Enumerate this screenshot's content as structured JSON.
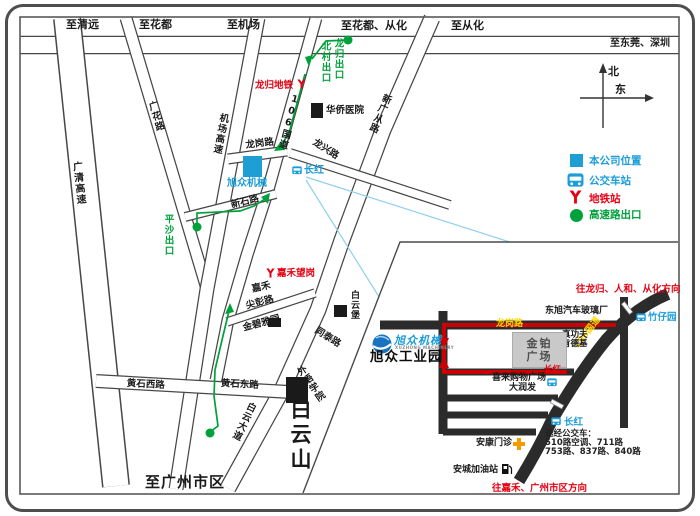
{
  "colors": {
    "company_blue": "#1b9dd9",
    "metro_red": "#e60012",
    "route_green": "#00a13b",
    "road_label_yellow": "#ffd800",
    "route_red": "#cc0000"
  },
  "top": {
    "qingyuan": "至清远",
    "huadu": "至花都",
    "airport": "至机场",
    "huadu_conghua": "至花都、从化",
    "conghua": "至从化",
    "dongguan_shenzhen": "至东莞、深圳"
  },
  "compass": {
    "north": "北",
    "east": "东"
  },
  "legend": {
    "company": "本公司位置",
    "bus_station": "公交车站",
    "metro_station": "地铁站",
    "highway_exit": "高速路出口"
  },
  "roads": {
    "guangqing_expwy": "广清高速",
    "guanghua_rd": "广花路",
    "airport_expwy": "机场高速",
    "national_rd_106": "106国道",
    "xinguangcong_rd": "新广从路",
    "longgang_rd": "龙岗路",
    "longxing_rd": "龙兴路",
    "xinshi_rd": "新石路",
    "jianpeng_rd": "尖彭路",
    "tongtai_rd": "同泰路",
    "huangshi_west_rd": "黄石西路",
    "huangshi_east_rd": "黄石东路",
    "baiyun_ave": "白云大道"
  },
  "places": {
    "longgui_metro": "龙归地铁",
    "beicun_exit": "北村出口",
    "longgui_exit": "龙归出口",
    "pingsha_exit": "平沙出口",
    "overseas_hospital": "华侨医院",
    "changhong": "长红",
    "company_name": "旭众机械",
    "jiahe_wanggang": "嘉禾望岗",
    "jiahe": "嘉禾",
    "jinbi_garden": "金碧雅园",
    "baiyun_fort": "白云堡",
    "foreign_college": "外语学院",
    "baiyun_mountain": "白云山",
    "to_guangzhou": "至广州市区"
  },
  "inset": {
    "dir_north": "往龙归、人和、从化方向",
    "dir_south": "往嘉禾、广州市区方向",
    "glass_factory": "东旭汽车玻璃厂",
    "zhuziyuan": "竹仔园",
    "longgang_rd": "龙岗路",
    "national_rd_106": "106国道",
    "jinbo_line1": "金铂",
    "jinbo_line2": "广场",
    "zhengongfu": "真功夫",
    "kfc": "肯德基",
    "xilai_plaza": "喜来购物广场",
    "darunfa": "大润发",
    "changhong_stop_red": "长红",
    "changhong_stop_blue": "长红",
    "bus_lines_title": "途经公交车：",
    "bus_lines_1": "510路空调、711路",
    "bus_lines_2": "753路、837路、840路",
    "ankang_clinic": "安康门诊",
    "ancheng_gas": "安城加油站",
    "logo_name": "旭众机械",
    "logo_caption": "XUZHONG MACHINERY",
    "park_name": "旭众工业园"
  }
}
